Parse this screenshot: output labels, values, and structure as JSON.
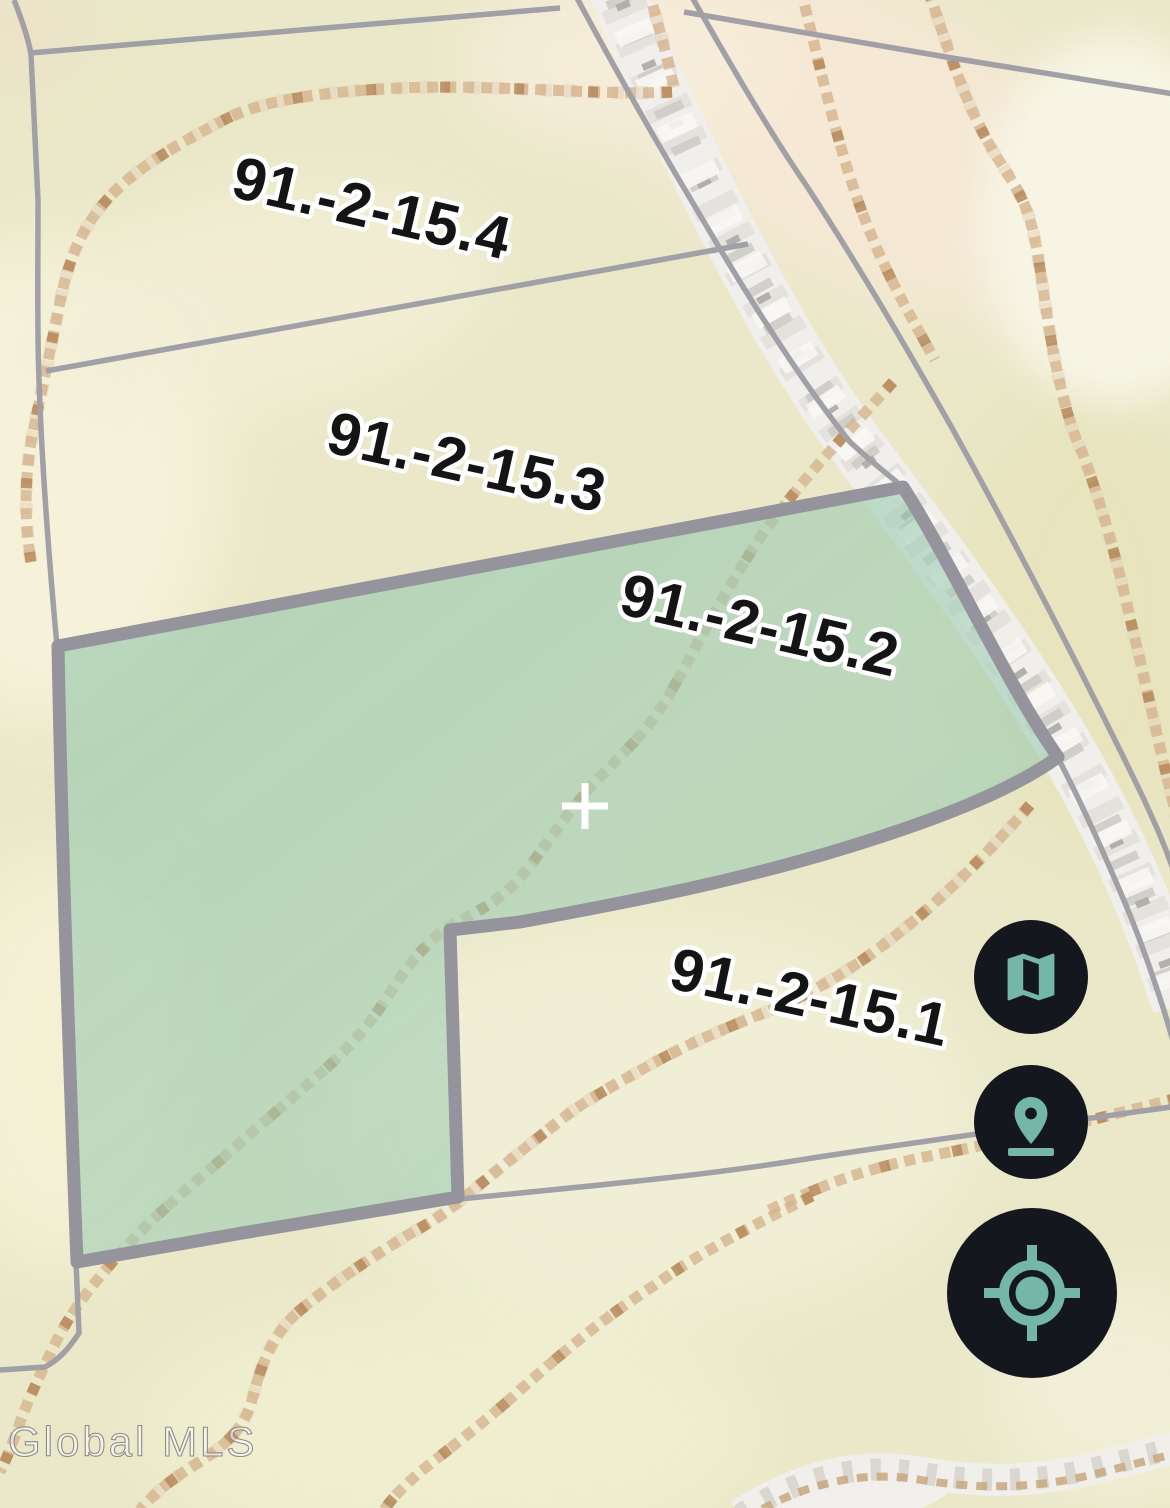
{
  "window": {
    "width": 1170,
    "height": 1508
  },
  "map": {
    "type": "tax-parcel-topo-map",
    "watermark": "Global MLS",
    "selected_parcel_id": "91.-2-15.2",
    "parcels": [
      {
        "id": "91.-2-15.4",
        "selected": false
      },
      {
        "id": "91.-2-15.3",
        "selected": false
      },
      {
        "id": "91.-2-15.2",
        "selected": true
      },
      {
        "id": "91.-2-15.1",
        "selected": false
      }
    ],
    "colors": {
      "accent_teal": "#74b7a8",
      "control_background": "#15171f",
      "map_background": "#eae8c8",
      "selected_parcel_fill": "#a6cfb4",
      "selected_parcel_border": "#95949c",
      "contour_line": "#c9a477",
      "road_fill": "#f0efec",
      "parcel_line": "#a0a0a6",
      "label_text": "#141414",
      "label_halo": "#ffffff",
      "watermark": "#8c8c8c",
      "crosshair": "#ffffff"
    }
  },
  "controls": {
    "map_type_button": {
      "icon": "map-icon"
    },
    "pin_button": {
      "icon": "location-pin-icon"
    },
    "locate_button": {
      "icon": "locate-icon"
    }
  }
}
